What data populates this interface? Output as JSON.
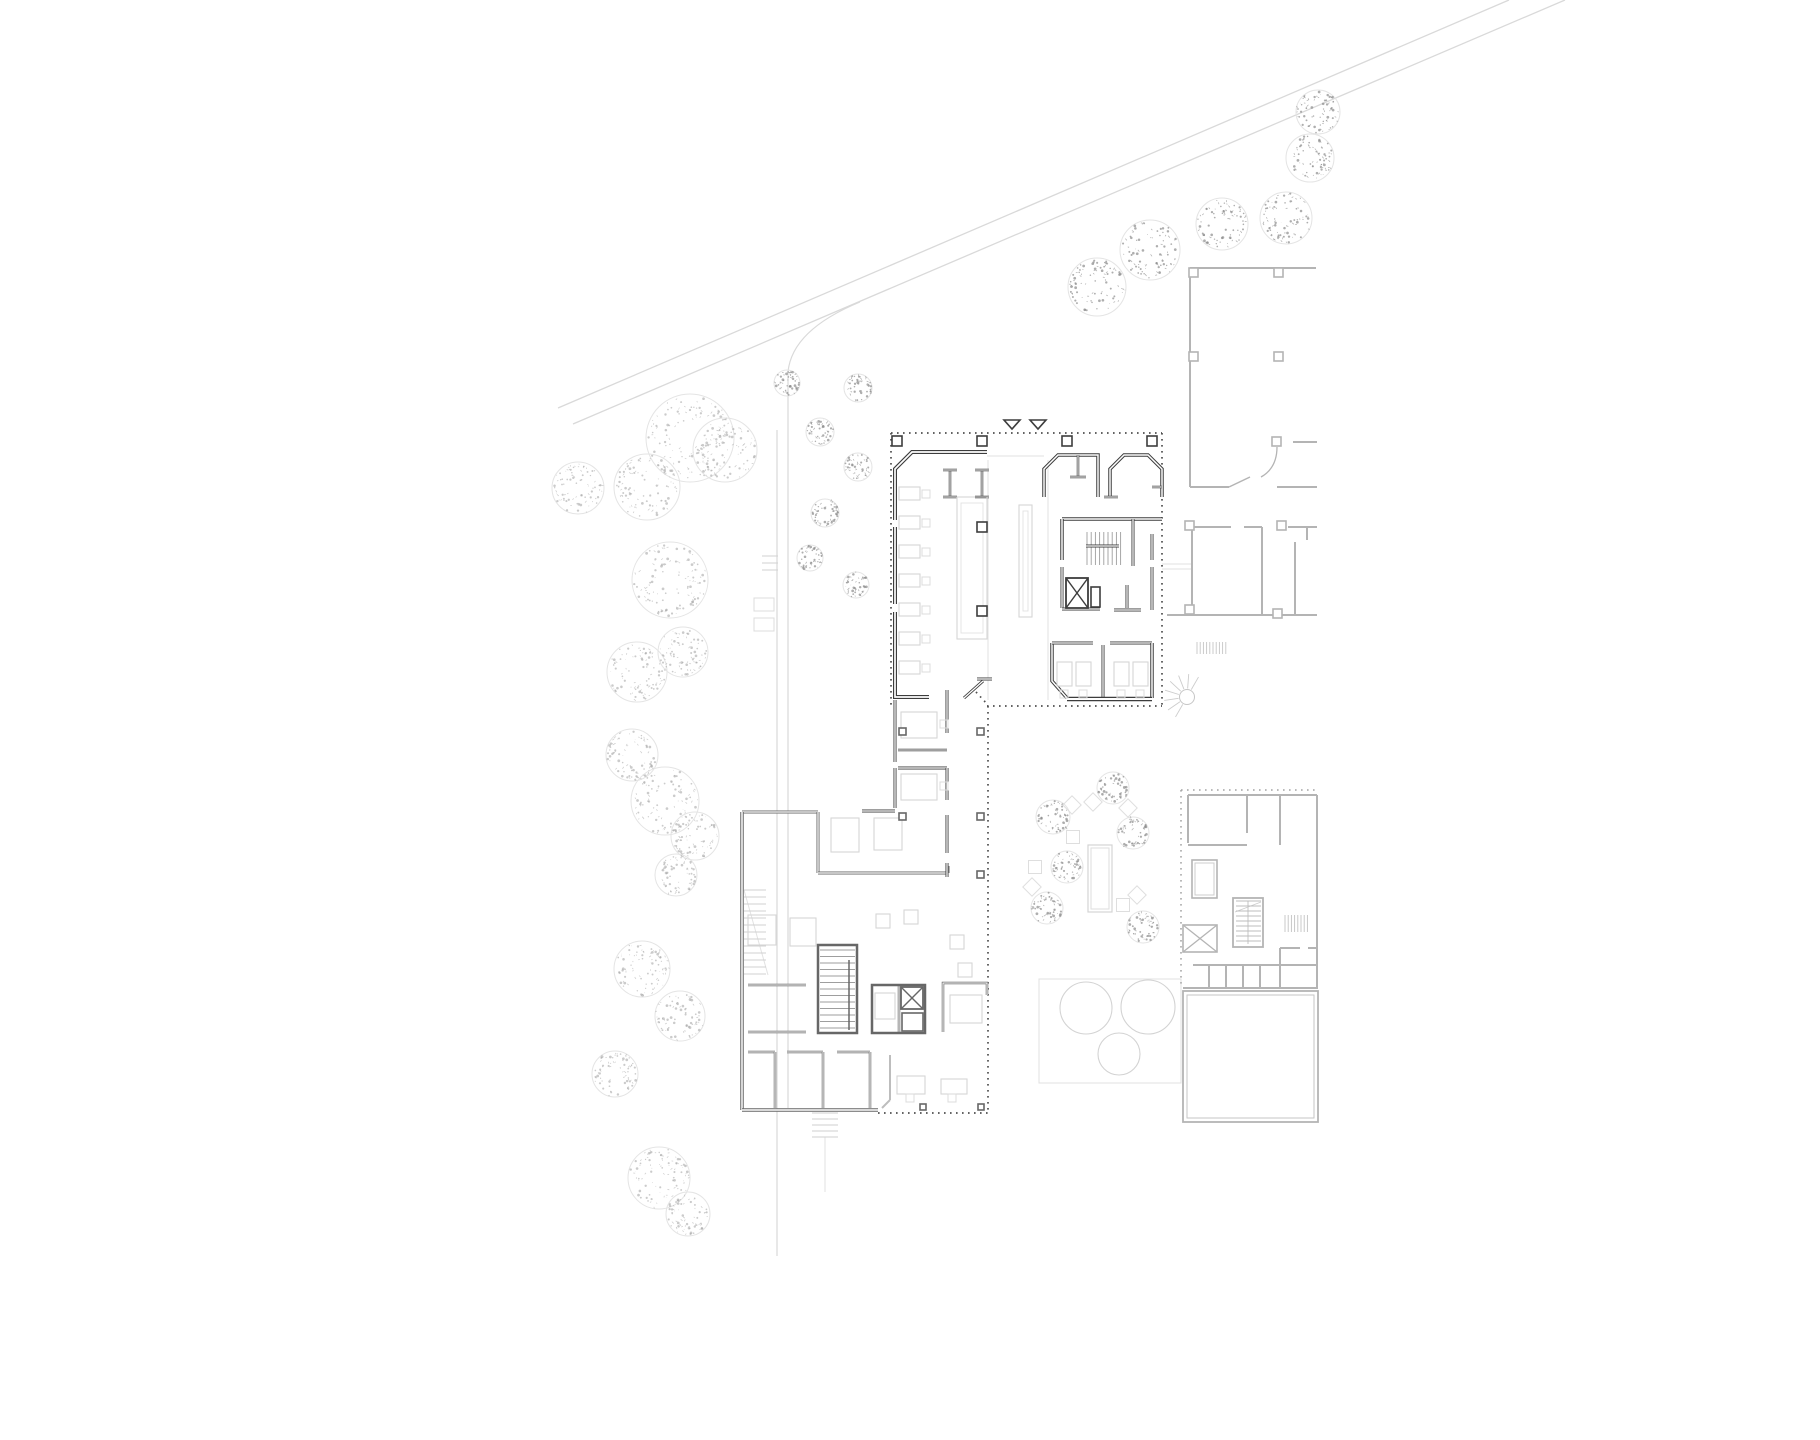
{
  "canvas": {
    "width": 1820,
    "height": 1440,
    "background": "#ffffff"
  },
  "palette": {
    "wall_dark": "#3d3d3d",
    "wall_mid": "#676767",
    "wall_light": "#b4b4b4",
    "wall_faint": "#cfcfcf",
    "furniture": "#d6d6d6",
    "road": "#d9d9d9",
    "dots_dark": "#4f4f4f",
    "dots_light": "#a3a3a3",
    "tree_dot_dark": "#8b8b8b",
    "tree_dot_light": "#a9a9a9",
    "tree_outline": "#e4e4e4",
    "white": "#ffffff"
  },
  "roads": {
    "lines": [
      [
        1509,
        0,
        558,
        408
      ],
      [
        1565,
        0,
        573,
        424
      ]
    ],
    "paths": [
      "M860,302 Q792,330 788,372 L788,1108",
      "M777,430 L777,1256"
    ],
    "ticks": [
      [
        762,
        556,
        778,
        556
      ],
      [
        762,
        563,
        778,
        563
      ],
      [
        762,
        570,
        778,
        570
      ]
    ],
    "benches": [
      [
        754,
        598,
        20,
        13
      ],
      [
        754,
        618,
        20,
        13
      ]
    ]
  },
  "trees": {
    "large": [
      [
        690,
        438,
        44
      ],
      [
        725,
        450,
        32
      ],
      [
        647,
        487,
        33
      ],
      [
        578,
        488,
        26
      ],
      [
        670,
        580,
        38
      ],
      [
        637,
        672,
        30
      ],
      [
        683,
        652,
        25
      ],
      [
        632,
        755,
        26
      ],
      [
        665,
        801,
        34
      ],
      [
        695,
        836,
        24
      ],
      [
        676,
        875,
        21
      ],
      [
        642,
        969,
        28
      ],
      [
        680,
        1016,
        25
      ],
      [
        615,
        1074,
        23
      ],
      [
        659,
        1178,
        31
      ],
      [
        688,
        1214,
        22
      ]
    ],
    "dark": [
      [
        1150,
        250,
        30
      ],
      [
        1222,
        224,
        26
      ],
      [
        1286,
        218,
        26
      ],
      [
        1310,
        158,
        24
      ],
      [
        1097,
        287,
        29
      ],
      [
        1318,
        112,
        22
      ],
      [
        858,
        388,
        14
      ],
      [
        820,
        432,
        14
      ],
      [
        858,
        467,
        14
      ],
      [
        825,
        513,
        14
      ],
      [
        810,
        558,
        13
      ],
      [
        856,
        585,
        13
      ],
      [
        787,
        383,
        13
      ],
      [
        1053,
        817,
        17
      ],
      [
        1113,
        788,
        16
      ],
      [
        1133,
        833,
        16
      ],
      [
        1067,
        867,
        16
      ],
      [
        1047,
        908,
        16
      ],
      [
        1143,
        927,
        16
      ]
    ]
  },
  "main_building": {
    "polylines": [
      {
        "pts": [
          [
            987,
            452
          ],
          [
            912,
            452
          ],
          [
            895,
            469
          ],
          [
            895,
            520
          ]
        ],
        "w": 4
      },
      {
        "pts": [
          [
            895,
            527
          ],
          [
            895,
            604
          ]
        ],
        "w": 4
      },
      {
        "pts": [
          [
            895,
            612
          ],
          [
            895,
            697
          ],
          [
            929,
            697
          ]
        ],
        "w": 4
      },
      {
        "pts": [
          [
            1044,
            497
          ],
          [
            1044,
            469
          ],
          [
            1058,
            455
          ],
          [
            1098,
            455
          ],
          [
            1098,
            497
          ]
        ],
        "w": 3.5
      },
      {
        "pts": [
          [
            1110,
            497
          ],
          [
            1110,
            469
          ],
          [
            1124,
            455
          ],
          [
            1148,
            455
          ],
          [
            1162,
            469
          ],
          [
            1162,
            497
          ]
        ],
        "w": 3.5
      },
      {
        "pts": [
          [
            1052,
            643
          ],
          [
            1052,
            681
          ],
          [
            1067,
            698
          ]
        ],
        "w": 3.5
      },
      {
        "pts": [
          [
            862,
            811
          ],
          [
            895,
            811
          ]
        ],
        "w": 3
      }
    ],
    "lines": [
      [
        950,
        470,
        950,
        497,
        2.5
      ],
      [
        943,
        470,
        957,
        470,
        2.5
      ],
      [
        943,
        497,
        957,
        497,
        2.5
      ],
      [
        982,
        470,
        982,
        497,
        2.5
      ],
      [
        975,
        470,
        989,
        470,
        2.5
      ],
      [
        975,
        497,
        989,
        497,
        2.5
      ],
      [
        1078,
        455,
        1078,
        476,
        2.5
      ],
      [
        1070,
        477,
        1086,
        477,
        2.5
      ],
      [
        1152,
        487,
        1162,
        487,
        2.5
      ],
      [
        1104,
        497,
        1118,
        497,
        2.5
      ],
      [
        1062,
        519,
        1162,
        519,
        3.5
      ],
      [
        1062,
        519,
        1062,
        560,
        3.5
      ],
      [
        1133,
        519,
        1133,
        566,
        3
      ],
      [
        1086,
        546,
        1119,
        546,
        3
      ],
      [
        1062,
        567,
        1062,
        608,
        3
      ],
      [
        1127,
        585,
        1127,
        608,
        3
      ],
      [
        1114,
        610,
        1141,
        610,
        3
      ],
      [
        1152,
        534,
        1152,
        560,
        3
      ],
      [
        1152,
        567,
        1152,
        610,
        3
      ],
      [
        1062,
        609,
        1100,
        609,
        3
      ],
      [
        1052,
        643,
        1093,
        643,
        3
      ],
      [
        1110,
        643,
        1152,
        643,
        3
      ],
      [
        1103,
        645,
        1103,
        698,
        3
      ],
      [
        1152,
        643,
        1152,
        698,
        3.5
      ],
      [
        1067,
        699,
        1152,
        699,
        4.5
      ],
      [
        964,
        698,
        983,
        681,
        3
      ],
      [
        977,
        679,
        992,
        679,
        3
      ],
      [
        895,
        700,
        895,
        762,
        3
      ],
      [
        895,
        768,
        895,
        808,
        3
      ],
      [
        898,
        750,
        947,
        750,
        2.5
      ],
      [
        898,
        768,
        947,
        768,
        3
      ],
      [
        947,
        690,
        947,
        733,
        3
      ],
      [
        947,
        768,
        947,
        800,
        3
      ],
      [
        947,
        815,
        947,
        853,
        3
      ],
      [
        947,
        863,
        947,
        877,
        3
      ]
    ],
    "xbox": {
      "x": 1066,
      "y": 578,
      "w": 22,
      "h": 30
    },
    "small_room": [
      1091,
      587,
      9,
      20
    ],
    "entrance_triangles": [
      [
        1012,
        420
      ],
      [
        1038,
        420
      ]
    ]
  },
  "lower_building": {
    "lines": [
      [
        742,
        812,
        818,
        812,
        3
      ],
      [
        818,
        812,
        818,
        873,
        3
      ],
      [
        818,
        873,
        948,
        873,
        3
      ],
      [
        948,
        866,
        948,
        873,
        3
      ],
      [
        742,
        812,
        742,
        1110,
        3.5
      ],
      [
        742,
        1110,
        878,
        1110,
        3.5
      ],
      [
        748,
        985,
        806,
        985,
        2.5
      ],
      [
        748,
        1032,
        806,
        1032,
        2.5
      ],
      [
        748,
        1052,
        775,
        1052,
        2.5
      ],
      [
        787,
        1052,
        823,
        1052,
        2.5
      ],
      [
        837,
        1052,
        870,
        1052,
        2.5
      ],
      [
        775,
        1052,
        775,
        1108,
        2.5
      ],
      [
        823,
        1052,
        823,
        1108,
        2.5
      ],
      [
        870,
        1052,
        870,
        1108,
        2.5
      ],
      [
        899,
        985,
        899,
        1033,
        2.5
      ],
      [
        849,
        958,
        849,
        1030,
        1.5
      ]
    ],
    "polylines": [
      {
        "pts": [
          [
            943,
            1032
          ],
          [
            943,
            983
          ],
          [
            987,
            983
          ],
          [
            987,
            995
          ]
        ],
        "w": 2.5
      }
    ],
    "light_lines": [
      [
        890,
        1055,
        890,
        1100,
        2
      ],
      [
        890,
        1100,
        882,
        1108,
        2
      ]
    ],
    "stair_rect": [
      818,
      945,
      39,
      88
    ],
    "elev_rect": [
      872,
      985,
      53,
      48
    ],
    "elev_cell": [
      902,
      1013,
      21,
      18
    ],
    "xbox": {
      "x": 901,
      "y": 987,
      "w": 22,
      "h": 22
    }
  },
  "neighbors": {
    "lines": [
      [
        1190,
        268,
        1316,
        268,
        2
      ],
      [
        1190,
        268,
        1190,
        487,
        2
      ],
      [
        1190,
        487,
        1229,
        487,
        2
      ],
      [
        1277,
        487,
        1317,
        487,
        2
      ],
      [
        1229,
        487,
        1250,
        477,
        1.5
      ],
      [
        1293,
        442,
        1317,
        442,
        2
      ],
      [
        1192,
        527,
        1231,
        527,
        2
      ],
      [
        1244,
        527,
        1262,
        527,
        2
      ],
      [
        1288,
        527,
        1317,
        527,
        2
      ],
      [
        1192,
        527,
        1192,
        615,
        2
      ],
      [
        1262,
        527,
        1262,
        615,
        2
      ],
      [
        1295,
        542,
        1295,
        615,
        2
      ],
      [
        1307,
        527,
        1307,
        540,
        2
      ],
      [
        1167,
        615,
        1317,
        615,
        2
      ],
      [
        1188,
        795,
        1317,
        795,
        2
      ],
      [
        1188,
        795,
        1188,
        843,
        2
      ],
      [
        1188,
        845,
        1247,
        845,
        2
      ],
      [
        1247,
        795,
        1247,
        833,
        2
      ],
      [
        1280,
        795,
        1280,
        845,
        2
      ],
      [
        1317,
        795,
        1317,
        988,
        2
      ],
      [
        1193,
        965,
        1317,
        965,
        2
      ],
      [
        1209,
        965,
        1209,
        988,
        2
      ],
      [
        1226,
        965,
        1226,
        988,
        2
      ],
      [
        1243,
        965,
        1243,
        988,
        2
      ],
      [
        1260,
        965,
        1260,
        988,
        2
      ],
      [
        1183,
        988,
        1318,
        988,
        2
      ],
      [
        1280,
        948,
        1280,
        988,
        2
      ],
      [
        1280,
        948,
        1300,
        948,
        2
      ],
      [
        1308,
        948,
        1317,
        948,
        2
      ]
    ],
    "door_leaf": "M1277,447 Q1277,468 1261,477",
    "square_room": [
      1192,
      860,
      25,
      38
    ],
    "stair_rect": [
      1233,
      898,
      30,
      49
    ],
    "big_rect": [
      1183,
      991,
      135,
      131
    ],
    "xbox": {
      "x": 1183,
      "y": 925,
      "w": 34,
      "h": 27
    },
    "spiral": {
      "cx": 1187,
      "cy": 697,
      "r": 7.5,
      "fan_r": 23,
      "a1": 120,
      "a2": 300,
      "rays": 7
    }
  },
  "stair_treads": [
    {
      "x1": 1087,
      "x2": 1121,
      "y1": 532,
      "y2": 565,
      "dir": "v",
      "step": 4.2,
      "c": "#9e9e9e"
    },
    {
      "x1": 820,
      "x2": 855,
      "y1": 950,
      "y2": 1030,
      "dir": "h",
      "step": 6.5,
      "c": "#9e9e9e"
    },
    {
      "x1": 744,
      "x2": 766,
      "y1": 890,
      "y2": 976,
      "dir": "h",
      "step": 7,
      "c": "#d0d0d0"
    },
    {
      "x1": 812,
      "x2": 838,
      "y1": 1113,
      "y2": 1137,
      "dir": "h",
      "step": 6,
      "c": "#cfcfcf"
    },
    {
      "x1": 1197,
      "x2": 1228,
      "y1": 642,
      "y2": 654,
      "dir": "v",
      "step": 3.2,
      "c": "#c6c6c6"
    },
    {
      "x1": 1285,
      "x2": 1308,
      "y1": 915,
      "y2": 932,
      "dir": "v",
      "step": 3.2,
      "c": "#c2c2c2"
    },
    {
      "x1": 1236,
      "x2": 1261,
      "y1": 901,
      "y2": 945,
      "dir": "h",
      "step": 5,
      "c": "#bdbdbd"
    }
  ],
  "dotted_dark": [
    [
      891,
      433,
      1162,
      433
    ],
    [
      891,
      433,
      891,
      706
    ],
    [
      1162,
      433,
      1162,
      706
    ],
    [
      987,
      706,
      1162,
      706
    ],
    [
      988,
      706,
      988,
      1113
    ],
    [
      878,
      1113,
      990,
      1113
    ],
    [
      976,
      692,
      988,
      705
    ]
  ],
  "dotted_light": [
    [
      1181,
      790,
      1318,
      790
    ],
    [
      1181,
      790,
      1181,
      988
    ]
  ],
  "faint_lines": [
    [
      987,
      456,
      1044,
      456
    ],
    [
      988,
      460,
      988,
      700
    ],
    [
      1048,
      460,
      1048,
      700
    ],
    [
      1162,
      564,
      1192,
      564
    ],
    [
      1162,
      569,
      1192,
      569
    ],
    [
      825,
      1137,
      825,
      1192
    ],
    [
      744,
      890,
      768,
      975
    ]
  ],
  "columns": {
    "dark10": [
      [
        892,
        436
      ],
      [
        977,
        436
      ],
      [
        1062,
        436
      ],
      [
        1147,
        436
      ],
      [
        977,
        522
      ],
      [
        977,
        606
      ]
    ],
    "mid7": [
      [
        899,
        728
      ],
      [
        899,
        813
      ],
      [
        977,
        728
      ],
      [
        977,
        813
      ],
      [
        977,
        871
      ]
    ],
    "mid6": [
      [
        920,
        1104
      ],
      [
        978,
        1104
      ]
    ],
    "light9": [
      [
        1189,
        268
      ],
      [
        1274,
        268
      ],
      [
        1189,
        352
      ],
      [
        1274,
        352
      ],
      [
        1272,
        437
      ],
      [
        1277,
        521
      ],
      [
        1185,
        521
      ],
      [
        1185,
        605
      ],
      [
        1273,
        609
      ]
    ]
  },
  "furniture": {
    "desks": [
      [
        899,
        487,
        21,
        13
      ],
      [
        899,
        516,
        21,
        13
      ],
      [
        899,
        545,
        21,
        13
      ],
      [
        899,
        574,
        21,
        13
      ],
      [
        899,
        603,
        21,
        13
      ],
      [
        899,
        632,
        21,
        13
      ],
      [
        899,
        661,
        21,
        13
      ],
      [
        957,
        497,
        30,
        142
      ],
      [
        1019,
        505,
        13,
        112
      ],
      [
        1057,
        662,
        15,
        24
      ],
      [
        1076,
        662,
        15,
        24
      ],
      [
        1114,
        662,
        15,
        24
      ],
      [
        1133,
        662,
        15,
        24
      ],
      [
        901,
        712,
        36,
        26
      ],
      [
        901,
        774,
        36,
        26
      ],
      [
        831,
        818,
        28,
        34
      ],
      [
        874,
        818,
        28,
        32
      ],
      [
        950,
        995,
        32,
        28
      ],
      [
        875,
        993,
        20,
        26
      ],
      [
        748,
        915,
        28,
        30
      ],
      [
        790,
        918,
        26,
        28
      ],
      [
        897,
        1076,
        28,
        18
      ],
      [
        941,
        1079,
        26,
        15
      ],
      [
        876,
        914,
        14,
        14
      ],
      [
        904,
        910,
        14,
        14
      ],
      [
        950,
        935,
        14,
        14
      ],
      [
        958,
        963,
        14,
        14
      ]
    ],
    "chairs": [
      [
        922,
        490
      ],
      [
        922,
        519
      ],
      [
        922,
        548
      ],
      [
        922,
        577
      ],
      [
        922,
        606
      ],
      [
        922,
        635
      ],
      [
        922,
        664
      ],
      [
        940,
        720
      ],
      [
        940,
        782
      ],
      [
        1060,
        690
      ],
      [
        1079,
        690
      ],
      [
        1117,
        690
      ],
      [
        1136,
        690
      ],
      [
        906,
        1094
      ],
      [
        948,
        1094
      ]
    ]
  },
  "courtyard": {
    "planter": [
      1088,
      845,
      24,
      67
    ],
    "pavers": [
      {
        "x": 1072,
        "y": 805,
        "rot": 45
      },
      {
        "x": 1093,
        "y": 802,
        "rot": 45
      },
      {
        "x": 1128,
        "y": 808,
        "rot": 45
      },
      {
        "x": 1073,
        "y": 837,
        "rot": 0
      },
      {
        "x": 1035,
        "y": 867,
        "rot": 0
      },
      {
        "x": 1032,
        "y": 887,
        "rot": 45
      },
      {
        "x": 1137,
        "y": 895,
        "rot": 45
      },
      {
        "x": 1123,
        "y": 905,
        "rot": 0
      }
    ],
    "paver_size": 13
  },
  "tanks": {
    "rect": [
      1039,
      979,
      142,
      104
    ],
    "circles": [
      [
        1086,
        1008,
        26
      ],
      [
        1148,
        1007,
        27
      ],
      [
        1119,
        1054,
        21
      ]
    ]
  }
}
